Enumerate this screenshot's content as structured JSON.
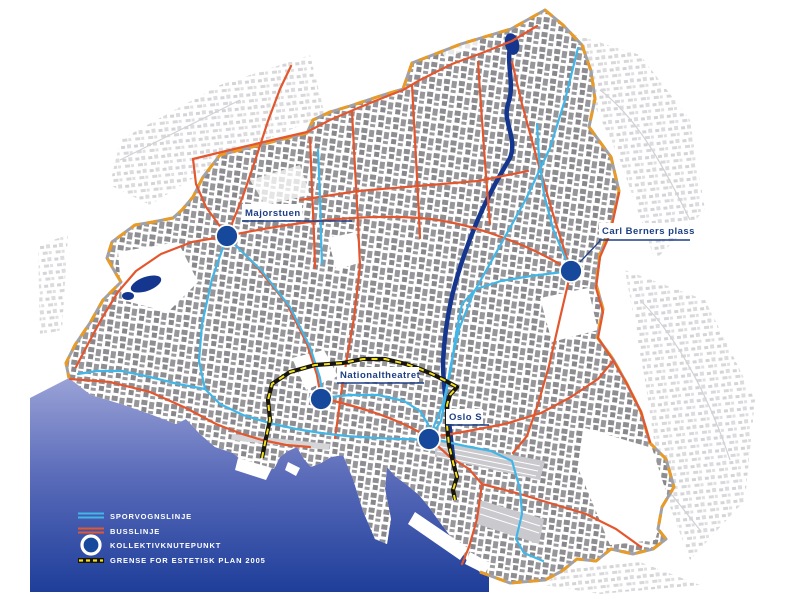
{
  "hubs": [
    {
      "id": "majorstuen",
      "label": "Majorstuen"
    },
    {
      "id": "carl-berners-plass",
      "label": "Carl Berners plass"
    },
    {
      "id": "nationaltheatret",
      "label": "Nationaltheatret"
    },
    {
      "id": "oslo-s",
      "label": "Oslo S"
    }
  ],
  "legend": {
    "items": [
      {
        "id": "tram",
        "label": "SPORVOGNSLINJE",
        "color": "#41b6e8"
      },
      {
        "id": "bus",
        "label": "BUSSLINJE",
        "color": "#e4572e"
      },
      {
        "id": "hub",
        "label": "KOLLEKTIVKNUTEPUNKT",
        "color": "#16489c"
      },
      {
        "id": "plan",
        "label": "GRENSE FOR ESTETISK PLAN 2005",
        "color": "#f4e11c"
      }
    ]
  },
  "colors": {
    "tram_line": "#41b6e8",
    "bus_line": "#e4572e",
    "hub_marker": "#16489c",
    "plan_boundary_yellow": "#f4e11c",
    "plan_boundary_black": "#17150c",
    "municipal_boundary_orange": "#e89b26",
    "municipal_boundary_grey": "#a2a2a6",
    "river": "#15368e",
    "water_light": "#9aa2d6",
    "water_dark": "#1e3e9a",
    "label_text": "#1d3f85",
    "legend_text": "#ffffff"
  }
}
